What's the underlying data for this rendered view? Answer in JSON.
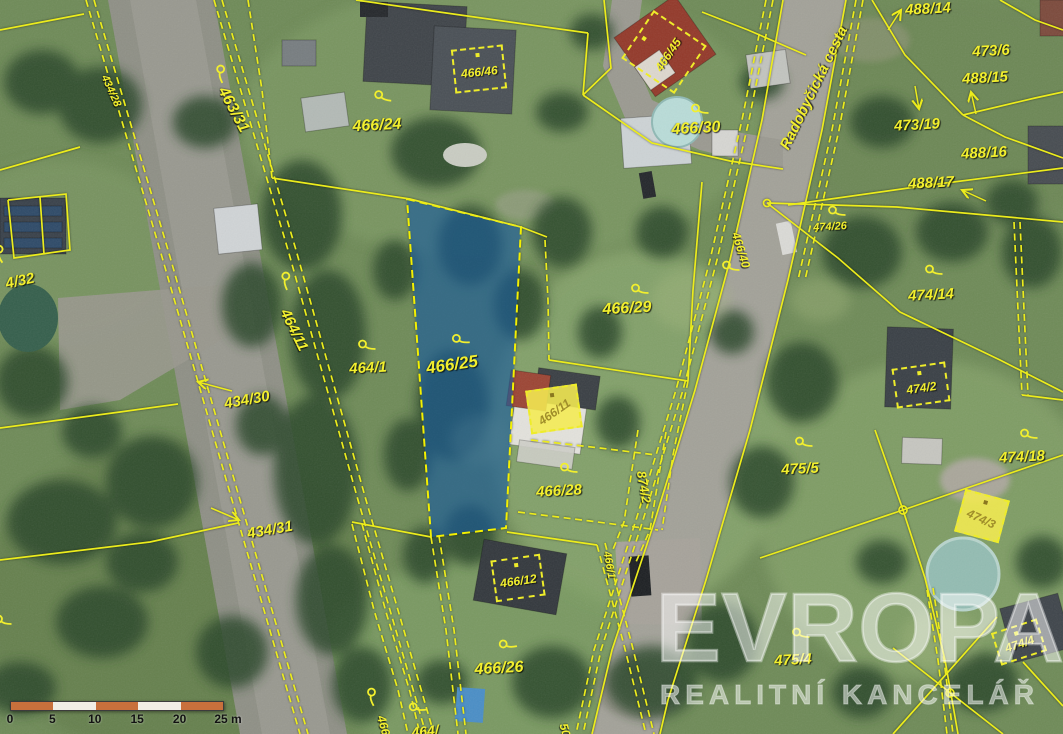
{
  "map": {
    "street_label": {
      "text": "Radobyčická cesta",
      "x": 814,
      "y": 88,
      "rot": -64,
      "size": 15
    },
    "highlighted_parcel": {
      "number": "466/25",
      "fill": "#2074c8"
    },
    "labels": [
      {
        "text": "463/31",
        "x": 233,
        "y": 110,
        "rot": 62,
        "size": 16,
        "sym": {
          "x": 221,
          "y": 74,
          "rot": 62
        }
      },
      {
        "text": "434/28",
        "x": 111,
        "y": 91,
        "rot": 66,
        "size": 11
      },
      {
        "text": "466/24",
        "x": 377,
        "y": 126,
        "rot": -3,
        "size": 16,
        "sym": {
          "x": 383,
          "y": 97,
          "rot": 5
        }
      },
      {
        "text": "464/11",
        "x": 294,
        "y": 330,
        "rot": 64,
        "size": 15,
        "sym": {
          "x": 286,
          "y": 281,
          "rot": 64
        }
      },
      {
        "text": "464/1",
        "x": 368,
        "y": 368,
        "rot": -3,
        "size": 15,
        "sym": {
          "x": 367,
          "y": 346,
          "rot": 0
        }
      },
      {
        "text": "434/30",
        "x": 247,
        "y": 400,
        "rot": -10,
        "size": 15
      },
      {
        "text": "434/31",
        "x": 270,
        "y": 530,
        "rot": -10,
        "size": 15
      },
      {
        "text": "466/25",
        "x": 452,
        "y": 365,
        "rot": -8,
        "size": 17,
        "sym": {
          "x": 461,
          "y": 340,
          "rot": -5
        }
      },
      {
        "text": "466/29",
        "x": 627,
        "y": 309,
        "rot": -3,
        "size": 16,
        "sym": {
          "x": 640,
          "y": 290,
          "rot": 0
        }
      },
      {
        "text": "466/28",
        "x": 559,
        "y": 491,
        "rot": -3,
        "size": 15,
        "sym": {
          "x": 569,
          "y": 469,
          "rot": 0
        }
      },
      {
        "text": "466/30",
        "x": 696,
        "y": 129,
        "rot": -3,
        "size": 16,
        "sym": {
          "x": 700,
          "y": 110,
          "rot": 0
        }
      },
      {
        "text": "466/26",
        "x": 499,
        "y": 669,
        "rot": -3,
        "size": 16,
        "sym": {
          "x": 508,
          "y": 645,
          "rot": -12
        }
      },
      {
        "text": "474/26",
        "x": 830,
        "y": 227,
        "rot": -3,
        "size": 11,
        "sym": {
          "x": 837,
          "y": 212,
          "rot": 0
        }
      },
      {
        "text": "488/14",
        "x": 928,
        "y": 9,
        "rot": -3,
        "size": 15
      },
      {
        "text": "473/6",
        "x": 991,
        "y": 51,
        "rot": -3,
        "size": 15
      },
      {
        "text": "488/15",
        "x": 985,
        "y": 78,
        "rot": -3,
        "size": 15
      },
      {
        "text": "473/19",
        "x": 917,
        "y": 125,
        "rot": -3,
        "size": 15
      },
      {
        "text": "488/16",
        "x": 984,
        "y": 153,
        "rot": -3,
        "size": 15
      },
      {
        "text": "488/17",
        "x": 931,
        "y": 183,
        "rot": -3,
        "size": 15
      },
      {
        "text": "474/14",
        "x": 931,
        "y": 295,
        "rot": -3,
        "size": 15,
        "sym": {
          "x": 934,
          "y": 271,
          "rot": 0
        }
      },
      {
        "text": "474/18",
        "x": 1022,
        "y": 457,
        "rot": -3,
        "size": 15,
        "sym": {
          "x": 1029,
          "y": 435,
          "rot": 0
        }
      },
      {
        "text": "475/5",
        "x": 800,
        "y": 469,
        "rot": -3,
        "size": 15,
        "sym": {
          "x": 804,
          "y": 443,
          "rot": 0
        }
      },
      {
        "text": "475/4",
        "x": 793,
        "y": 660,
        "rot": -3,
        "size": 15,
        "sym": {
          "x": 801,
          "y": 634,
          "rot": 0
        }
      },
      {
        "text": "874/2",
        "x": 644,
        "y": 487,
        "rot": 80,
        "size": 13
      },
      {
        "text": "466/40",
        "x": 741,
        "y": 250,
        "rot": 73,
        "size": 12
      },
      {
        "text": "466/1",
        "x": 609,
        "y": 565,
        "rot": 80,
        "size": 11
      },
      {
        "text": "4/32",
        "x": 20,
        "y": 281,
        "rot": -12,
        "size": 15
      },
      {
        "text": "466/",
        "x": 384,
        "y": 727,
        "rot": 75,
        "size": 12,
        "sym": {
          "x": 372,
          "y": 697,
          "rot": 60
        }
      },
      {
        "text": "464/",
        "x": 425,
        "y": 731,
        "rot": -6,
        "size": 14,
        "sym": {
          "x": 418,
          "y": 708,
          "rot": -10
        }
      },
      {
        "text": "50",
        "x": 565,
        "y": 730,
        "rot": 75,
        "size": 12
      },
      {
        "text": "",
        "sym": {
          "x": 731,
          "y": 267,
          "rot": 0
        }
      },
      {
        "text": "",
        "sym": {
          "x": 3,
          "y": 621,
          "rot": 0
        }
      },
      {
        "text": "",
        "sym": {
          "x": 0,
          "y": 254,
          "rot": 55
        }
      }
    ],
    "building_labels": [
      {
        "text": "466/46",
        "trot": -6,
        "filled": false,
        "box": {
          "x": 479,
          "y": 69,
          "w": 52,
          "h": 44,
          "rot": -6
        }
      },
      {
        "text": "466/45",
        "trot": -56,
        "filled": false,
        "box": {
          "x": 664,
          "y": 52,
          "w": 58,
          "h": 64,
          "rot": -56
        }
      },
      {
        "text": "466/12",
        "trot": -8,
        "filled": false,
        "box": {
          "x": 518,
          "y": 578,
          "w": 50,
          "h": 42,
          "rot": -8
        }
      },
      {
        "text": "466/11",
        "trot": -35,
        "filled": true,
        "box": {
          "x": 554,
          "y": 409,
          "w": 52,
          "h": 44,
          "rot": -8
        }
      },
      {
        "text": "474/2",
        "trot": -8,
        "filled": false,
        "box": {
          "x": 921,
          "y": 385,
          "w": 54,
          "h": 40,
          "rot": -8
        }
      },
      {
        "text": "474/3",
        "trot": 25,
        "filled": true,
        "box": {
          "x": 982,
          "y": 516,
          "w": 46,
          "h": 44,
          "rot": 15
        }
      },
      {
        "text": "474/4",
        "trot": -18,
        "filled": false,
        "box": {
          "x": 1019,
          "y": 642,
          "w": 48,
          "h": 34,
          "rot": -18
        }
      }
    ],
    "scale_bar": {
      "unit_labels": [
        "0",
        "5",
        "10",
        "15",
        "20",
        "25 m"
      ],
      "bar_colors": [
        "#c8703c",
        "#f1ede5",
        "#c8703c",
        "#f1ede5",
        "#c8703c"
      ]
    },
    "watermark": {
      "brand": "EVROPA",
      "tagline": "REALITNÍ KANCELÁŘ"
    },
    "colors": {
      "boundary_line": "#ecec1c",
      "parcel_label": "#f2ef2e",
      "highlight_fill": "#2074c8",
      "scale_orange": "#c8703c"
    }
  }
}
